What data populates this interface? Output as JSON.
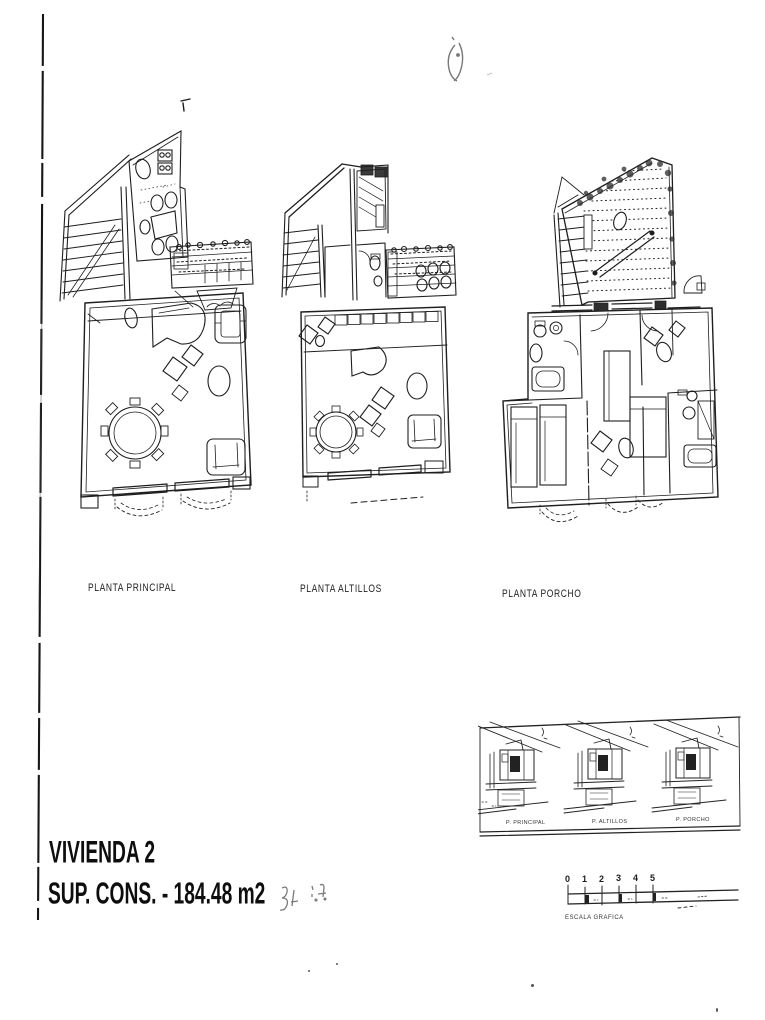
{
  "document": {
    "kind": "scanned architectural plan sheet"
  },
  "plans": [
    {
      "label": "PLANTA PRINCIPAL"
    },
    {
      "label": "PLANTA ALTILLOS"
    },
    {
      "label": "PLANTA PORCHO"
    }
  ],
  "title_block": {
    "project": "VIVIENDA 2",
    "area": "SUP. CONS. - 184.48 m2"
  },
  "scale_bar": {
    "ticks": [
      "0",
      "1",
      "2",
      "3",
      "4",
      "5"
    ],
    "label": "ESCALA GRAFICA"
  },
  "elevations": {
    "captions": [
      "P. PRINCIPAL",
      "P. ALTILLOS",
      "P. PORCHO"
    ]
  },
  "colors": {
    "paper": "#ffffff",
    "ink": "#1c1c1c"
  }
}
